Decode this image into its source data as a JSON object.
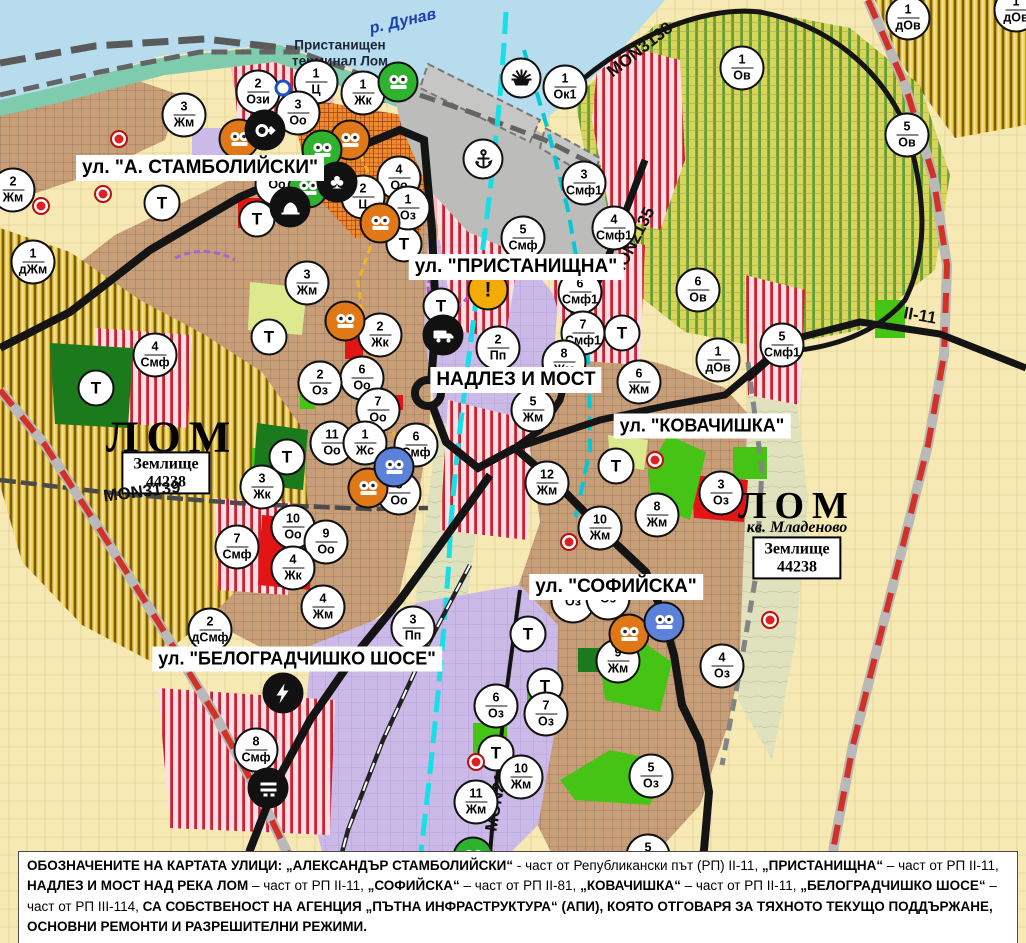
{
  "map": {
    "river": {
      "t": "р. Дунав"
    },
    "terminal": {
      "t1": "Пристанищен",
      "t2": "терминал Лом"
    },
    "streets": [
      {
        "t": "ул. \"А. СТАМБОЛИЙСКИ\"",
        "x": 200,
        "y": 168,
        "fs": 19
      },
      {
        "t": "ул. \"ПРИСТАНИЩНА\"",
        "x": 516,
        "y": 267,
        "fs": 19
      },
      {
        "t": "НАДЛЕЗ И МОСТ",
        "x": 516,
        "y": 380,
        "fs": 19
      },
      {
        "t": "ул. \"КОВАЧИШКА\"",
        "x": 702,
        "y": 426,
        "fs": 18
      },
      {
        "t": "ул. \"СОФИЙСКА\"",
        "x": 616,
        "y": 587,
        "fs": 19
      },
      {
        "t": "ул. \"БЕЛОГРАДЧИШКО ШОСЕ\"",
        "x": 297,
        "y": 659,
        "fs": 18
      }
    ],
    "road_codes": [
      {
        "t": "MON3138",
        "x": 640,
        "y": 50,
        "r": -38
      },
      {
        "t": "MON2135",
        "x": 633,
        "y": 243,
        "r": -63
      },
      {
        "t": "MON3139",
        "x": 142,
        "y": 492,
        "r": -7
      },
      {
        "t": "MON2136",
        "x": 498,
        "y": 793,
        "r": -80
      },
      {
        "t": "II-11",
        "x": 920,
        "y": 316,
        "r": 10
      }
    ],
    "area_titles": [
      {
        "t": "ЛОМ",
        "x": 172,
        "y": 437,
        "fs": 44
      },
      {
        "t": "ЛОМ",
        "x": 797,
        "y": 506,
        "fs": 38
      }
    ],
    "area_subs": [
      {
        "t": "кв. Младеново",
        "x": 797,
        "y": 528
      }
    ],
    "landmark_boxes": [
      {
        "l1": "Землище",
        "l2": "44238",
        "x": 166,
        "y": 473
      },
      {
        "l1": "Землище",
        "l2": "44238",
        "x": 797,
        "y": 558
      }
    ],
    "markers": {
      "zones": [
        {
          "n": "2",
          "c": "Ози",
          "x": 258,
          "y": 92
        },
        {
          "n": "1",
          "c": "Ц",
          "x": 316,
          "y": 82
        },
        {
          "n": "3",
          "c": "Оо",
          "x": 298,
          "y": 113
        },
        {
          "n": "1",
          "c": "Жк",
          "x": 363,
          "y": 93
        },
        {
          "n": "3",
          "c": "Жм",
          "x": 184,
          "y": 115
        },
        {
          "n": "2",
          "c": "Жм",
          "x": 13,
          "y": 190
        },
        {
          "n": "1",
          "c": "дЖм",
          "x": 33,
          "y": 262
        },
        {
          "n": "4",
          "c": "Оо",
          "x": 399,
          "y": 178
        },
        {
          "n": "",
          "c": "Оо",
          "x": 277,
          "y": 184
        },
        {
          "n": "2",
          "c": "Ц",
          "x": 363,
          "y": 197
        },
        {
          "n": "1",
          "c": "Оз",
          "x": 408,
          "y": 208
        },
        {
          "n": "3",
          "c": "Жм",
          "x": 307,
          "y": 283
        },
        {
          "n": "1",
          "c": "Ок1",
          "x": 565,
          "y": 87
        },
        {
          "n": "3",
          "c": "Смф1",
          "x": 584,
          "y": 183
        },
        {
          "n": "5",
          "c": "Смф",
          "x": 523,
          "y": 238
        },
        {
          "n": "6",
          "c": "Смф1",
          "x": 580,
          "y": 292
        },
        {
          "n": "7",
          "c": "Смф1",
          "x": 583,
          "y": 333
        },
        {
          "n": "2",
          "c": "Пп",
          "x": 498,
          "y": 348
        },
        {
          "n": "8",
          "c": "Жм",
          "x": 564,
          "y": 362
        },
        {
          "n": "5",
          "c": "Жм",
          "x": 533,
          "y": 410
        },
        {
          "n": "6",
          "c": "Жм",
          "x": 639,
          "y": 382
        },
        {
          "n": "2",
          "c": "Жк",
          "x": 380,
          "y": 335
        },
        {
          "n": "6",
          "c": "Оо",
          "x": 362,
          "y": 378
        },
        {
          "n": "7",
          "c": "Оо",
          "x": 378,
          "y": 410
        },
        {
          "n": "2",
          "c": "Оз",
          "x": 320,
          "y": 383
        },
        {
          "n": "11",
          "c": "Оо",
          "x": 332,
          "y": 443
        },
        {
          "n": "1",
          "c": "Жс",
          "x": 365,
          "y": 443
        },
        {
          "n": "6",
          "c": "Смф",
          "x": 416,
          "y": 445
        },
        {
          "n": "8",
          "c": "Оо",
          "x": 399,
          "y": 493
        },
        {
          "n": "3",
          "c": "Жк",
          "x": 262,
          "y": 487
        },
        {
          "n": "10",
          "c": "Оо",
          "x": 293,
          "y": 527
        },
        {
          "n": "9",
          "c": "Оо",
          "x": 326,
          "y": 542
        },
        {
          "n": "4",
          "c": "Жк",
          "x": 293,
          "y": 568
        },
        {
          "n": "4",
          "c": "Жм",
          "x": 323,
          "y": 607
        },
        {
          "n": "2",
          "c": "дСмф",
          "x": 210,
          "y": 630
        },
        {
          "n": "3",
          "c": "Пп",
          "x": 413,
          "y": 628
        },
        {
          "n": "8",
          "c": "Смф",
          "x": 256,
          "y": 750
        },
        {
          "n": "7",
          "c": "Смф",
          "x": 237,
          "y": 547
        },
        {
          "n": "4",
          "c": "Смф",
          "x": 155,
          "y": 355
        },
        {
          "n": "1",
          "c": "Ов",
          "x": 742,
          "y": 68
        },
        {
          "n": "5",
          "c": "Ов",
          "x": 907,
          "y": 135
        },
        {
          "n": "6",
          "c": "Ов",
          "x": 698,
          "y": 290
        },
        {
          "n": "4",
          "c": "Смф1",
          "x": 614,
          "y": 228
        },
        {
          "n": "1",
          "c": "дОв",
          "x": 908,
          "y": 18
        },
        {
          "n": "1",
          "c": "дОв",
          "x": 1016,
          "y": 10
        },
        {
          "n": "1",
          "c": "дОв",
          "x": 718,
          "y": 360
        },
        {
          "n": "5",
          "c": "Смф1",
          "x": 782,
          "y": 345
        },
        {
          "n": "3",
          "c": "Оз",
          "x": 721,
          "y": 493
        },
        {
          "n": "8",
          "c": "Жм",
          "x": 657,
          "y": 515
        },
        {
          "n": "10",
          "c": "Жм",
          "x": 600,
          "y": 528
        },
        {
          "n": "12",
          "c": "Жм",
          "x": 547,
          "y": 483
        },
        {
          "n": "9",
          "c": "Жм",
          "x": 618,
          "y": 661
        },
        {
          "n": "4",
          "c": "Оз",
          "x": 722,
          "y": 666
        },
        {
          "n": "",
          "c": "Оз",
          "x": 573,
          "y": 601
        },
        {
          "n": "",
          "c": "Оз",
          "x": 608,
          "y": 598
        },
        {
          "n": "6",
          "c": "Оз",
          "x": 496,
          "y": 706
        },
        {
          "n": "7",
          "c": "Оз",
          "x": 546,
          "y": 714
        },
        {
          "n": "10",
          "c": "Жм",
          "x": 521,
          "y": 777
        },
        {
          "n": "11",
          "c": "Жм",
          "x": 476,
          "y": 802
        },
        {
          "n": "5",
          "c": "Оз",
          "x": 651,
          "y": 776
        },
        {
          "n": "5",
          "c": "Оз",
          "x": 648,
          "y": 856
        }
      ],
      "transport": [
        {
          "x": 162,
          "y": 203
        },
        {
          "x": 257,
          "y": 219
        },
        {
          "x": 404,
          "y": 244
        },
        {
          "x": 441,
          "y": 306
        },
        {
          "x": 622,
          "y": 333
        },
        {
          "x": 269,
          "y": 337
        },
        {
          "x": 96,
          "y": 388
        },
        {
          "x": 287,
          "y": 457
        },
        {
          "x": 616,
          "y": 466
        },
        {
          "x": 528,
          "y": 634
        },
        {
          "x": 545,
          "y": 686
        },
        {
          "x": 496,
          "y": 753
        }
      ],
      "pois": [
        {
          "icon": "masks",
          "bg": "#e07818",
          "x": 239,
          "y": 139
        },
        {
          "icon": "masks",
          "bg": "#e07818",
          "x": 350,
          "y": 140
        },
        {
          "icon": "masks",
          "bg": "#e07818",
          "x": 380,
          "y": 223
        },
        {
          "icon": "masks",
          "bg": "#e07818",
          "x": 345,
          "y": 321
        },
        {
          "icon": "masks",
          "bg": "#e07818",
          "x": 368,
          "y": 488
        },
        {
          "icon": "masks",
          "bg": "#e07818",
          "x": 629,
          "y": 634
        },
        {
          "icon": "masks",
          "bg": "#2fb32f",
          "x": 398,
          "y": 82
        },
        {
          "icon": "masks",
          "bg": "#2fb32f",
          "x": 322,
          "y": 150
        },
        {
          "icon": "masks",
          "bg": "#2fb32f",
          "x": 308,
          "y": 188
        },
        {
          "icon": "masks",
          "bg": "#2fb32f",
          "x": 473,
          "y": 857
        },
        {
          "icon": "masks",
          "bg": "#5b82d8",
          "x": 394,
          "y": 467
        },
        {
          "icon": "masks",
          "bg": "#5b82d8",
          "x": 664,
          "y": 622
        },
        {
          "icon": "arrow",
          "bg": "#111111",
          "x": 265,
          "y": 130
        },
        {
          "icon": "club",
          "bg": "#111111",
          "x": 337,
          "y": 182
        },
        {
          "icon": "mound",
          "bg": "#111111",
          "x": 290,
          "y": 207
        },
        {
          "icon": "anchor",
          "bg": "#ffffff",
          "x": 483,
          "y": 159
        },
        {
          "icon": "sun",
          "bg": "#ffffff",
          "x": 521,
          "y": 78
        },
        {
          "icon": "truck",
          "bg": "#111111",
          "x": 443,
          "y": 335
        },
        {
          "icon": "lightning",
          "bg": "#111111",
          "x": 283,
          "y": 693
        },
        {
          "icon": "bars",
          "bg": "#111111",
          "x": 268,
          "y": 788
        },
        {
          "icon": "exclaim",
          "bg": "#f3ac05",
          "x": 488,
          "y": 290
        }
      ],
      "dots": [
        {
          "k": "red",
          "x": 119,
          "y": 139
        },
        {
          "k": "red",
          "x": 103,
          "y": 194
        },
        {
          "k": "red",
          "x": 41,
          "y": 206
        },
        {
          "k": "red",
          "x": 655,
          "y": 460
        },
        {
          "k": "red",
          "x": 569,
          "y": 542
        },
        {
          "k": "red",
          "x": 476,
          "y": 762
        },
        {
          "k": "red",
          "x": 770,
          "y": 620
        },
        {
          "k": "blue",
          "x": 283,
          "y": 88
        }
      ]
    },
    "legend": {
      "segments": [
        {
          "b": 1,
          "t": "ОБОЗНАЧЕНИТЕ НА КАРТАТА УЛИЦИ: „АЛЕКСАНДЪР СТАМБОЛИЙСКИ“"
        },
        {
          "b": 0,
          "t": " - част от Републикански път (РП) II-11, "
        },
        {
          "b": 1,
          "t": "„ПРИСТАНИЩНА“"
        },
        {
          "b": 0,
          "t": " – част от РП II-11, "
        },
        {
          "b": 1,
          "t": "НАДЛЕЗ И МОСТ НАД РЕКА ЛОМ"
        },
        {
          "b": 0,
          "t": " – част от РП II-11, "
        },
        {
          "b": 1,
          "t": "„СОФИЙСКА“"
        },
        {
          "b": 0,
          "t": " – част от РП II-81, "
        },
        {
          "b": 1,
          "t": "„КОВАЧИШКА“"
        },
        {
          "b": 0,
          "t": " – част от РП II-11, "
        },
        {
          "b": 1,
          "t": "„БЕЛОГРАДЧИШКО ШОСЕ“"
        },
        {
          "b": 0,
          "t": " – част от РП III-114, "
        },
        {
          "b": 1,
          "t": "СА СОБСТВЕНОСТ НА АГЕНЦИЯ „ПЪТНА ИНФРАСТРУКТУРА“ (АПИ), КОЯТО ОТГОВАРЯ ЗА ТЯХНОТО ТЕКУЩО ПОДДЪРЖАНЕ, ОСНОВНИ РЕМОНТИ И РАЗРЕШИТЕЛНИ РЕЖИМИ."
        }
      ]
    },
    "colors": {
      "river": "#b6dcee",
      "shore": "#7ecbad",
      "urban": "#c89e78",
      "gold": "#f2d245",
      "vineyard_stripe": "#63a033",
      "smf_stripe": "#cf2030",
      "purple": "#cbb9e8",
      "park": "#46c416",
      "dark_green": "#1b7a1b",
      "road": "#141414",
      "cyan": "#17dfe8",
      "farm": "#f7e9b4",
      "port": "#bcbcba",
      "red_zone": "#e31414"
    }
  }
}
